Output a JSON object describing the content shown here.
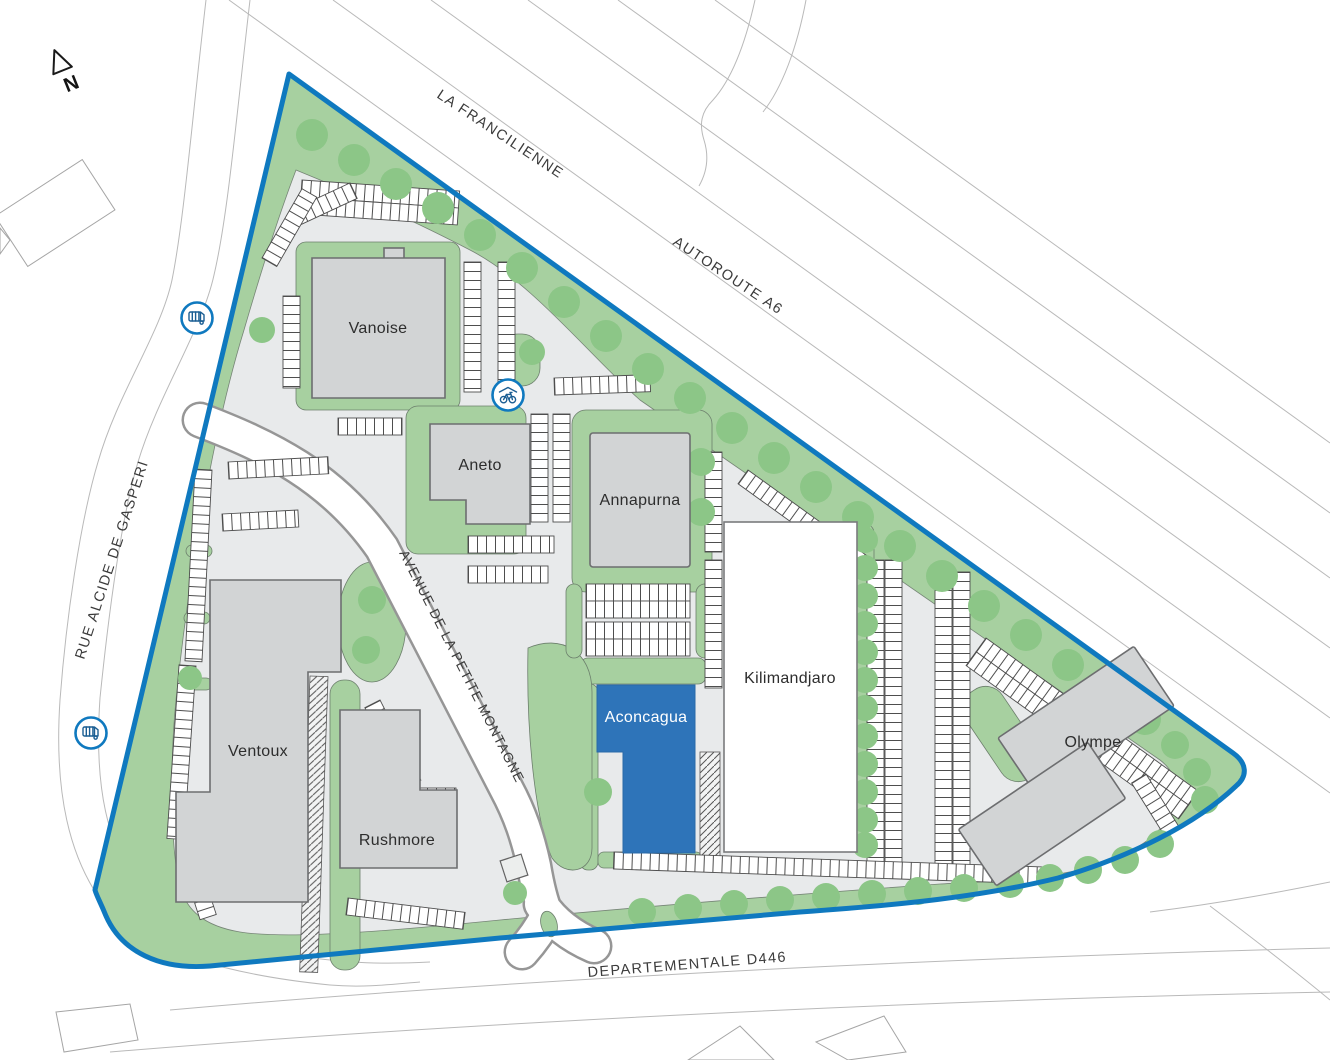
{
  "map": {
    "north": {
      "label": "N"
    },
    "roads": {
      "la_francilienne": "LA FRANCILIENNE",
      "autoroute_a6": "AUTOROUTE A6",
      "rue_alcide_de_gasperi": "RUE ALCIDE DE GASPERI",
      "avenue_petite_montagne": "AVENUE DE LA PETITE MONTAGNE",
      "departementale_d446": "DEPARTEMENTALE D446"
    },
    "buildings": [
      {
        "id": "vanoise",
        "label": "Vanoise",
        "highlighted": false
      },
      {
        "id": "aneto",
        "label": "Aneto",
        "highlighted": false
      },
      {
        "id": "annapurna",
        "label": "Annapurna",
        "highlighted": false
      },
      {
        "id": "kilimandjaro",
        "label": "Kilimandjaro",
        "highlighted": false
      },
      {
        "id": "aconcagua",
        "label": "Aconcagua",
        "highlighted": true
      },
      {
        "id": "ventoux",
        "label": "Ventoux",
        "highlighted": false
      },
      {
        "id": "rushmore",
        "label": "Rushmore",
        "highlighted": false
      },
      {
        "id": "olympe",
        "label": "Olympe",
        "highlighted": false
      }
    ],
    "icons": {
      "bus_stops": 2,
      "bike_shelters": 1
    },
    "colors": {
      "boundary_blue": "#0f79bf",
      "highlight_blue": "#2e74b9",
      "site_green": "#a7d0a0",
      "tree_green": "#8cc687",
      "paved_gray": "#e8eaeb",
      "building_gray": "#d2d4d5",
      "building_white": "#ffffff"
    }
  }
}
